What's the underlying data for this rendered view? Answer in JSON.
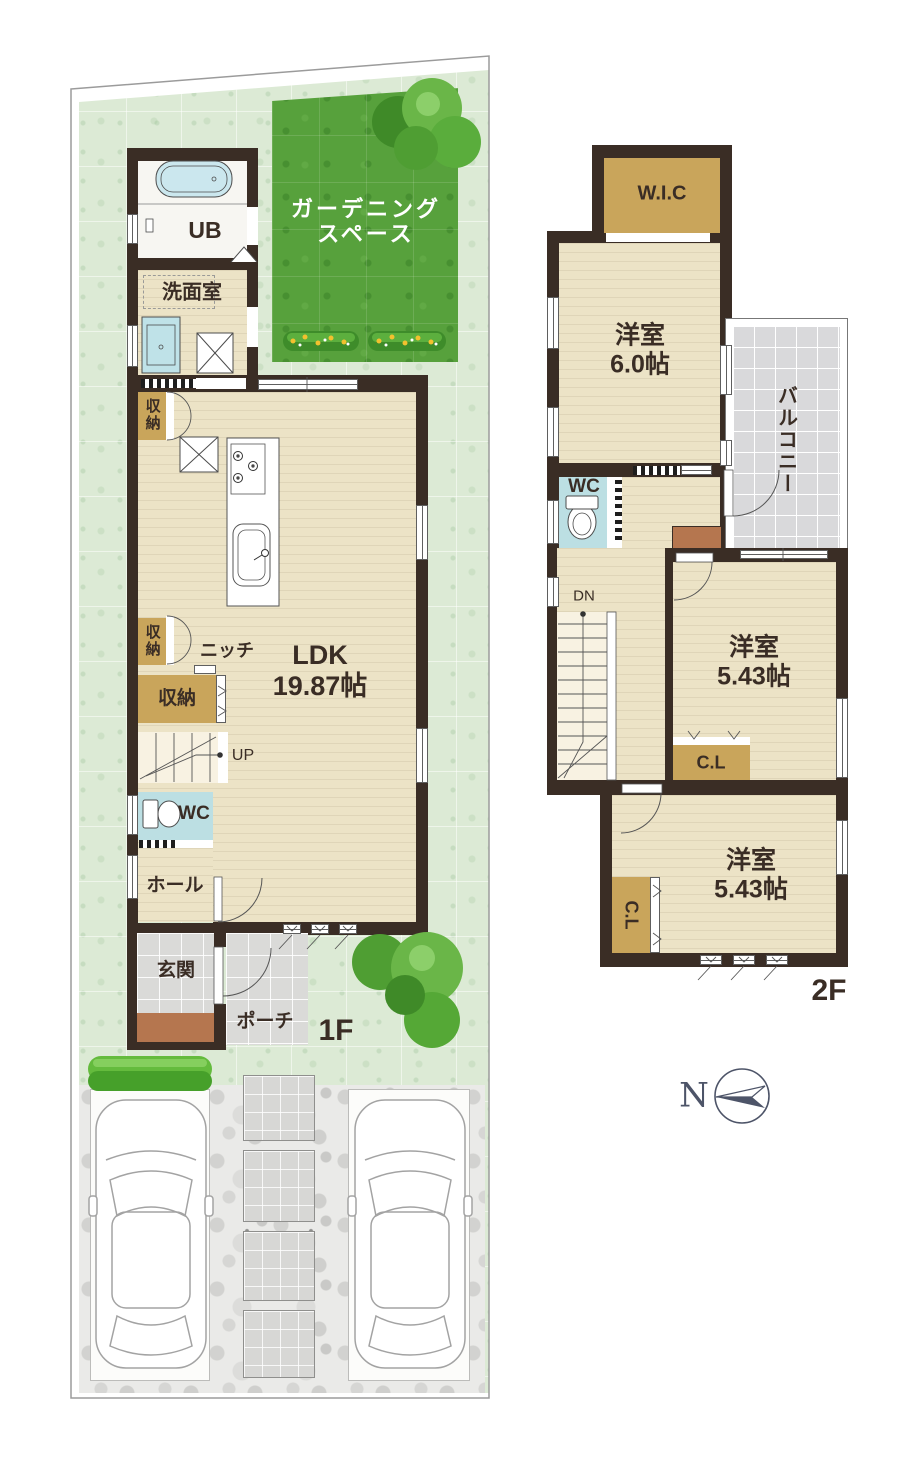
{
  "floor1": {
    "label": "1F",
    "ub": "UB",
    "washroom": "洗面室",
    "storage_top": "収納",
    "storage_mid": "収納",
    "storage_large": "収納",
    "niche": "ニッチ",
    "ldk_name": "LDK",
    "ldk_size": "19.87帖",
    "up": "UP",
    "wc": "WC",
    "hall": "ホール",
    "entrance": "玄関",
    "porch": "ポーチ",
    "garden_line1": "ガーデニング",
    "garden_line2": "スペース"
  },
  "floor2": {
    "label": "2F",
    "wic": "W.I.C",
    "room1_name": "洋室",
    "room1_size": "6.0帖",
    "balcony": "バルコニー",
    "wc": "WC",
    "down": "DN",
    "room2_name": "洋室",
    "room2_size": "5.43帖",
    "closet1": "C.L",
    "room3_name": "洋室",
    "room3_size": "5.43帖",
    "closet2": "C.L"
  },
  "compass": {
    "north": "N"
  },
  "palette": {
    "wall": "#3a2d25",
    "room_floor": "#ece3c6",
    "closet": "#c9a55b",
    "wc_blue": "#bcdfe3",
    "garden_green": "#57a13c",
    "lot_green": "#dcead5",
    "tile_gray": "#dadad8",
    "step_brown": "#b5764f",
    "compass_slate": "#4d5468"
  }
}
